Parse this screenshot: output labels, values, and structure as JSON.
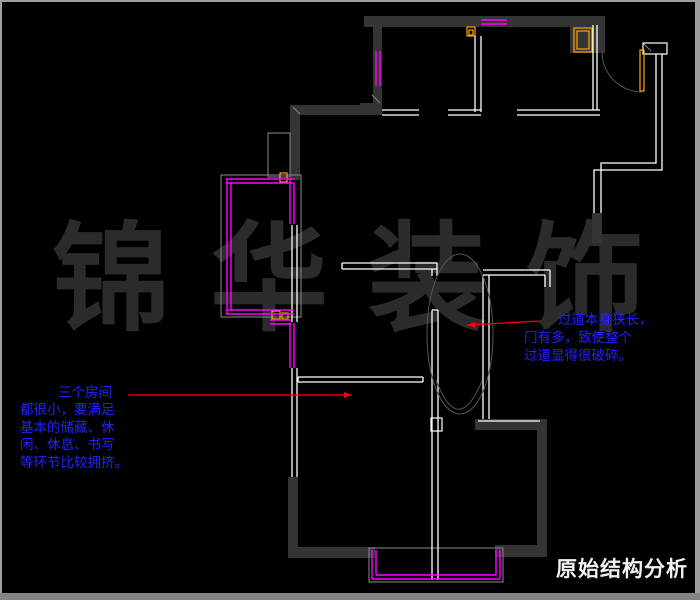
{
  "title": "原始结构分析",
  "watermark": "锦华装饰",
  "notes": {
    "left": {
      "lines": [
        "三个房间",
        "都很小，要满足",
        "基本的储藏、休",
        "闲、休息、书写",
        "等环节比较拥挤。"
      ]
    },
    "right": {
      "lines": [
        "过道本身狭长，",
        "门有多，致使整个",
        "过道显得很破碎。"
      ]
    }
  },
  "colors": {
    "background": "#000000",
    "frame": "#9e9e9e",
    "frame_bottom": "#848484",
    "wall_fill": "#343434",
    "wall_line": "#ffffff",
    "window": "#ff00ff",
    "door": "#ffa500",
    "guide": "#555555",
    "outline": "#8a8a8a",
    "leader": "#ff0000",
    "note": "#2222ff",
    "title_color": "#f2f2f2",
    "watermark_color": "#2b2b2b"
  },
  "plan": {
    "wall_rects": [
      [
        364,
        16,
        236,
        11
      ],
      [
        570,
        16,
        35,
        37
      ],
      [
        373,
        16,
        9,
        97
      ],
      [
        360,
        103,
        22,
        12
      ],
      [
        290,
        105,
        92,
        10
      ],
      [
        290,
        105,
        10,
        75
      ],
      [
        592,
        213,
        10,
        30
      ],
      [
        288,
        477,
        10,
        81
      ],
      [
        288,
        547,
        87,
        11
      ],
      [
        475,
        419,
        72,
        11
      ],
      [
        537,
        430,
        10,
        117
      ],
      [
        495,
        545,
        52,
        12
      ]
    ],
    "white_rects": [
      [
        643,
        43,
        24,
        11
      ],
      [
        431,
        418,
        11,
        13
      ]
    ],
    "gray_rects": [
      [
        268,
        133,
        22,
        44
      ],
      [
        221,
        175,
        80,
        142
      ],
      [
        369,
        548,
        134,
        34
      ]
    ],
    "orange_rects": [
      [
        574,
        28,
        18,
        24
      ],
      [
        577,
        31,
        12,
        18
      ],
      [
        467,
        27,
        8,
        9
      ],
      [
        469,
        30,
        4,
        5
      ],
      [
        640,
        50,
        4,
        41
      ],
      [
        280,
        173,
        7,
        9
      ],
      [
        272,
        311,
        8,
        8
      ],
      [
        282,
        313,
        6,
        6
      ]
    ],
    "white_lines": [
      [
        475,
        36,
        475,
        112
      ],
      [
        481,
        36,
        481,
        112
      ],
      [
        382,
        110,
        419,
        110
      ],
      [
        382,
        115,
        419,
        115
      ],
      [
        448,
        110,
        481,
        110
      ],
      [
        448,
        115,
        481,
        115
      ],
      [
        517,
        110,
        600,
        110
      ],
      [
        517,
        115,
        600,
        115
      ],
      [
        593,
        25,
        593,
        110
      ],
      [
        597,
        25,
        597,
        110
      ],
      [
        342,
        263,
        437,
        263
      ],
      [
        342,
        269,
        437,
        269
      ],
      [
        342,
        263,
        342,
        269
      ],
      [
        437,
        263,
        437,
        276
      ],
      [
        432,
        269,
        432,
        276
      ],
      [
        483,
        270,
        550,
        270
      ],
      [
        483,
        275,
        545,
        275
      ],
      [
        550,
        270,
        550,
        287
      ],
      [
        545,
        275,
        545,
        287
      ],
      [
        432,
        310,
        432,
        580
      ],
      [
        438,
        310,
        438,
        580
      ],
      [
        432,
        310,
        438,
        310
      ],
      [
        483,
        275,
        483,
        419
      ],
      [
        489,
        275,
        489,
        419
      ],
      [
        292,
        225,
        292,
        322
      ],
      [
        297,
        225,
        297,
        322
      ],
      [
        292,
        368,
        292,
        477
      ],
      [
        297,
        368,
        297,
        477
      ],
      [
        298,
        377,
        423,
        377
      ],
      [
        298,
        382,
        423,
        382
      ],
      [
        298,
        377,
        298,
        382
      ],
      [
        423,
        377,
        423,
        382
      ],
      [
        478,
        421,
        540,
        421
      ]
    ],
    "white_paths": [
      "M656,54 L656,163 L601,163 L601,213",
      "M662,54 L662,170 L594,170 L594,213"
    ],
    "magenta_lines": [
      [
        481,
        20,
        507,
        20
      ],
      [
        481,
        24,
        507,
        24
      ],
      [
        376,
        51,
        376,
        86
      ],
      [
        380,
        51,
        380,
        86
      ],
      [
        226,
        179,
        294,
        179
      ],
      [
        226,
        183,
        294,
        183
      ],
      [
        227,
        179,
        227,
        314
      ],
      [
        231,
        183,
        231,
        310
      ],
      [
        226,
        310,
        294,
        310
      ],
      [
        226,
        314,
        294,
        314
      ],
      [
        290,
        179,
        290,
        224
      ],
      [
        294,
        183,
        294,
        224
      ],
      [
        290,
        323,
        290,
        368
      ],
      [
        294,
        323,
        294,
        368
      ],
      [
        270,
        320,
        291,
        320
      ],
      [
        270,
        324,
        291,
        324
      ],
      [
        372,
        550,
        372,
        579
      ],
      [
        376,
        550,
        376,
        575
      ],
      [
        372,
        579,
        500,
        579
      ],
      [
        376,
        575,
        496,
        575
      ],
      [
        500,
        550,
        500,
        579
      ],
      [
        496,
        550,
        496,
        575
      ]
    ],
    "gray_lines": [
      [
        375,
        548,
        497,
        548
      ],
      [
        293,
        107,
        300,
        114
      ],
      [
        372,
        95,
        380,
        103
      ],
      [
        644,
        44,
        651,
        51
      ]
    ],
    "gray_paths": [
      "M602,52 A40,40 0 0 0 642,92",
      "M436,380 Q458,438 482,381"
    ],
    "ellipse": [
      460,
      334,
      33,
      80
    ],
    "red_lines": [
      [
        128,
        395,
        352,
        395
      ],
      [
        467,
        325,
        540,
        321
      ]
    ],
    "red_arrows": [
      "352,395 344,392 344,398",
      "467,325 475,322 475,328"
    ]
  }
}
